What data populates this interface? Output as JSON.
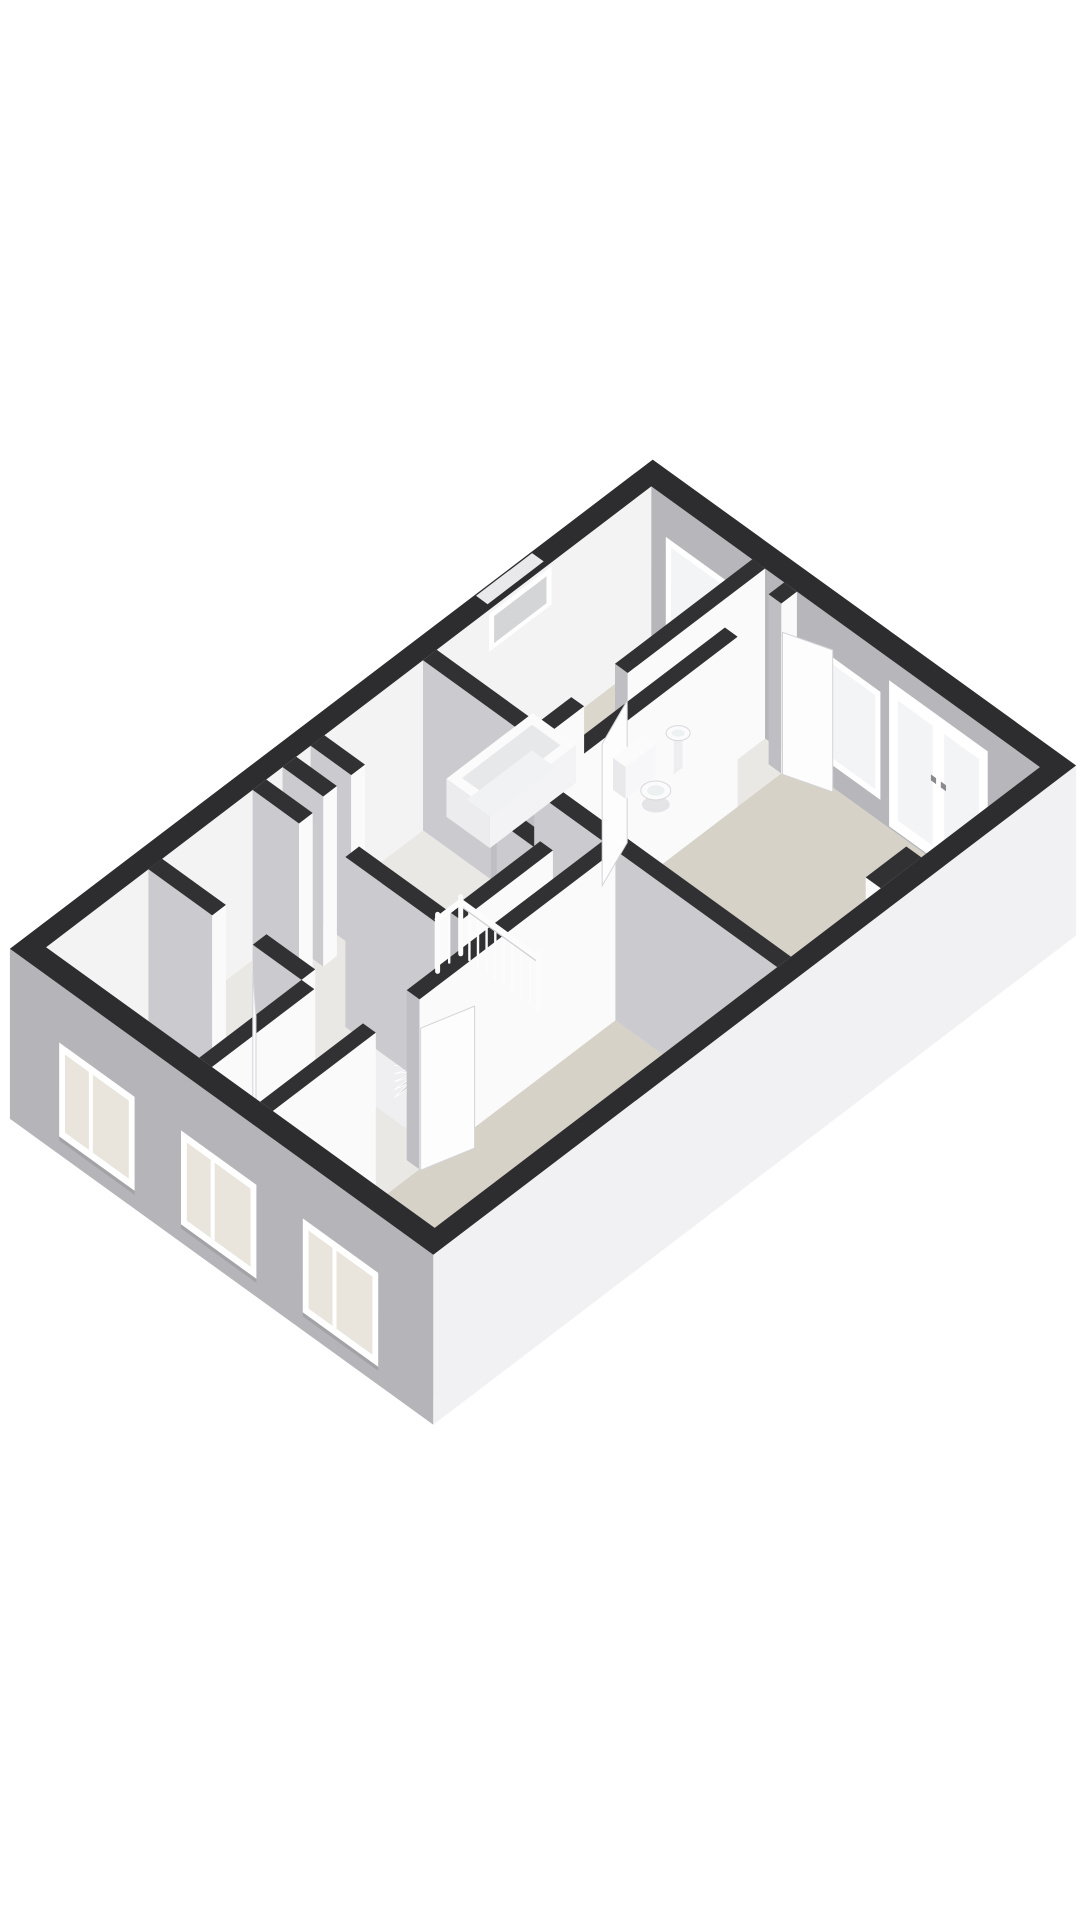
{
  "meta": {
    "kind": "3d-floor-plan-render",
    "width": 1080,
    "height": 1920
  },
  "palette": {
    "background": "#ffffff",
    "wall_top": "#2d2d2f",
    "wall_top_inner": "#313133",
    "face_white": "#fafafb",
    "face_gray": "#cbcbcf",
    "cap_gray": "#bfbfc3",
    "facade_sw": "#b5b5b9",
    "facade_se": "#f1f1f3",
    "ne_inner": "#b7b7bb",
    "nw_inner": "#f3f3f4",
    "floor_base": "#eae8e4",
    "floor_room": "#d6d2c8",
    "floor_bath": "#dbd7cd",
    "stair_hole": "#c4c4c6",
    "hole_wall_nw": "#dadadc",
    "hole_wall_sw": "#efeff1",
    "step_light": "#f6f6f7",
    "step_dark": "#d7d7d9",
    "frame": "#ffffff",
    "glass_warm": "#e9e5dc",
    "glass_cool": "#f2f4f5",
    "glass_slit": "#d3d5d6",
    "rail": "#fcfcfd",
    "rail_shadow": "#cfcfd2",
    "leaf": "#fdfdfe",
    "leaf_edge": "#d4d4d7",
    "fixture": "#fbfbfc",
    "fixture_shade": "#e7e8ea",
    "fixture_edge": "#d8d8db",
    "sill": "#e9e9eb"
  },
  "projection": {
    "origin": [
      28,
      948
    ],
    "axis_a": [
      62.4,
      -47.5
    ],
    "axis_b": [
      58.0,
      41.9
    ],
    "wall_height": 170,
    "units_a": 10,
    "units_b": 7,
    "ext_out": -0.15,
    "ext_in": 0.15
  },
  "floors": {
    "base": [
      [
        0.15,
        0.15
      ],
      [
        9.85,
        0.15
      ],
      [
        9.85,
        6.85
      ],
      [
        0.15,
        6.85
      ]
    ],
    "rooms": [
      {
        "name": "left-bedroom-floor",
        "color": "floor_room",
        "pts": [
          [
            0.15,
            0.15
          ],
          [
            1.79,
            0.15
          ],
          [
            1.79,
            2.79
          ],
          [
            0.15,
            2.79
          ]
        ]
      },
      {
        "name": "bottom-bedroom-floor",
        "color": "floor_room",
        "pts": [
          [
            0.15,
            4.06
          ],
          [
            5.64,
            4.06
          ],
          [
            5.64,
            6.85
          ],
          [
            0.15,
            6.85
          ]
        ]
      },
      {
        "name": "right-bedroom-floor",
        "color": "floor_room",
        "pts": [
          [
            5.86,
            2.66
          ],
          [
            9.85,
            2.66
          ],
          [
            9.85,
            6.85
          ],
          [
            5.86,
            6.85
          ]
        ]
      },
      {
        "name": "bathroom-floor",
        "color": "floor_bath",
        "pts": [
          [
            6.41,
            0.15
          ],
          [
            9.85,
            0.15
          ],
          [
            9.85,
            1.89
          ],
          [
            6.41,
            1.89
          ]
        ]
      }
    ],
    "stair_hole": [
      [
        3.68,
        1.85
      ],
      [
        5.15,
        1.85
      ],
      [
        5.15,
        3.29
      ],
      [
        3.68,
        3.29
      ]
    ]
  },
  "walls": [
    {
      "name": "left-room-se-wall",
      "axis": "A",
      "pos": 2.9,
      "segments": [
        [
          0.15,
          1.79
        ]
      ]
    },
    {
      "name": "left-room-ne-wall",
      "axis": "B",
      "pos": 1.9,
      "segments": [
        [
          0.15,
          1.25
        ],
        [
          1.95,
          2.79
        ]
      ]
    },
    {
      "name": "bottom-bedroom-nw-wall",
      "axis": "A",
      "pos": 3.95,
      "segments": [
        [
          0.15,
          1.8
        ],
        [
          2.5,
          5.64
        ]
      ]
    },
    {
      "name": "bedroom-divider-wall",
      "axis": "B",
      "pos": 5.75,
      "segments": [
        [
          2.66,
          6.85
        ]
      ]
    },
    {
      "name": "stair-sw-wall",
      "axis": "B",
      "pos": 3.57,
      "segments": [
        [
          0.15,
          0.95
        ],
        [
          1.75,
          3.29
        ]
      ]
    },
    {
      "name": "stair-se-wall",
      "axis": "A",
      "pos": 3.4,
      "segments": [
        [
          3.68,
          5.15
        ]
      ]
    },
    {
      "name": "hall-bedroom-wall",
      "axis": "A",
      "pos": 2.55,
      "segments": [
        [
          5.15,
          5.3
        ],
        [
          5.7,
          8.9
        ],
        [
          9.6,
          9.85
        ]
      ]
    },
    {
      "name": "bathroom-se-wall",
      "axis": "A",
      "pos": 2.0,
      "segments": [
        [
          6.41,
          6.95
        ],
        [
          7.65,
          9.85
        ]
      ]
    },
    {
      "name": "bathroom-sw-wall",
      "axis": "B",
      "pos": 6.3,
      "segments": [
        [
          0.15,
          1.89
        ]
      ]
    },
    {
      "name": "closet-sw-wall",
      "axis": "B",
      "pos": 5.15,
      "segments": [
        [
          2.66,
          3.29
        ]
      ]
    },
    {
      "name": "niche-divider-1",
      "axis": "B",
      "pos": 4.05,
      "segments": [
        [
          0.15,
          0.85
        ]
      ]
    },
    {
      "name": "niche-divider-2",
      "axis": "B",
      "pos": 4.5,
      "segments": [
        [
          0.15,
          0.85
        ]
      ]
    },
    {
      "name": "chimney-block",
      "axis": "A",
      "pos": 6.72,
      "t": 0.26,
      "cap": "face_white",
      "segments": [
        [
          7.3,
          7.95
        ]
      ]
    }
  ],
  "doors": [
    {
      "name": "left-room-door-leaf",
      "from": [
        1.79,
        1.95
      ],
      "to": [
        1.34,
        2.49
      ]
    },
    {
      "name": "bottom-bedroom-door-leaf",
      "from": [
        2.5,
        4.08
      ],
      "to": [
        3.16,
        4.3
      ]
    },
    {
      "name": "right-bedroom-door-leaf",
      "from": [
        9.6,
        2.68
      ],
      "to": [
        9.8,
        3.33
      ]
    },
    {
      "name": "bathroom-door-leaf",
      "from": [
        7.65,
        2.1
      ],
      "to": [
        6.99,
        2.38
      ]
    }
  ],
  "windows": {
    "sw": {
      "v": [
        58,
        152
      ],
      "mullion": 0.42,
      "items": [
        {
          "name": "sw-window-1",
          "u": [
            0.7,
            2.0
          ]
        },
        {
          "name": "sw-window-2",
          "u": [
            2.8,
            4.1
          ]
        },
        {
          "name": "sw-window-3",
          "u": [
            4.9,
            6.2
          ]
        }
      ]
    },
    "ne": {
      "items": [
        {
          "name": "bathroom-window",
          "type": "window",
          "u": [
            0.4,
            1.45
          ],
          "v": [
            40,
            138
          ]
        },
        {
          "name": "bedroom-window",
          "type": "window",
          "u": [
            3.05,
            4.1
          ],
          "v": [
            40,
            148
          ]
        },
        {
          "name": "bedroom-french-doors",
          "type": "french-door",
          "u": [
            4.25,
            5.95
          ],
          "v": [
            22,
            168
          ]
        }
      ]
    },
    "nw_slit": {
      "name": "nw-slit-window",
      "u": [
        7.25,
        8.25
      ],
      "v": [
        4,
        42
      ]
    }
  },
  "stairs": {
    "pivot": [
      3.9,
      2.12
    ],
    "radius": 1.12,
    "count": 9,
    "start_deg": 96,
    "step_deg": 11.5,
    "depth_start": 12,
    "depth_step": 8,
    "shaft_depth": 78
  },
  "railing": {
    "a": 5.15,
    "b": [
      1.92,
      3.26
    ],
    "return_a": [
      4.78,
      5.15
    ],
    "height": 52,
    "balusters": 10,
    "return_balusters": 3
  },
  "fixtures": {
    "bathtub": {
      "a": [
        6.52,
        7.9
      ],
      "b": [
        0.2,
        0.95
      ],
      "rim_h": 38,
      "inset": 0.13
    },
    "toilet": {
      "tank": {
        "a": [
          7.98,
          8.46
        ],
        "b": [
          1.5,
          1.72
        ],
        "h": 44
      },
      "bowl": {
        "center": [
          8.22,
          1.98
        ],
        "rx": 15,
        "ry": 9.5
      }
    },
    "basin": {
      "center": [
        8.82,
        1.72
      ],
      "rx": 12,
      "ry": 7.5,
      "h": 38
    }
  }
}
